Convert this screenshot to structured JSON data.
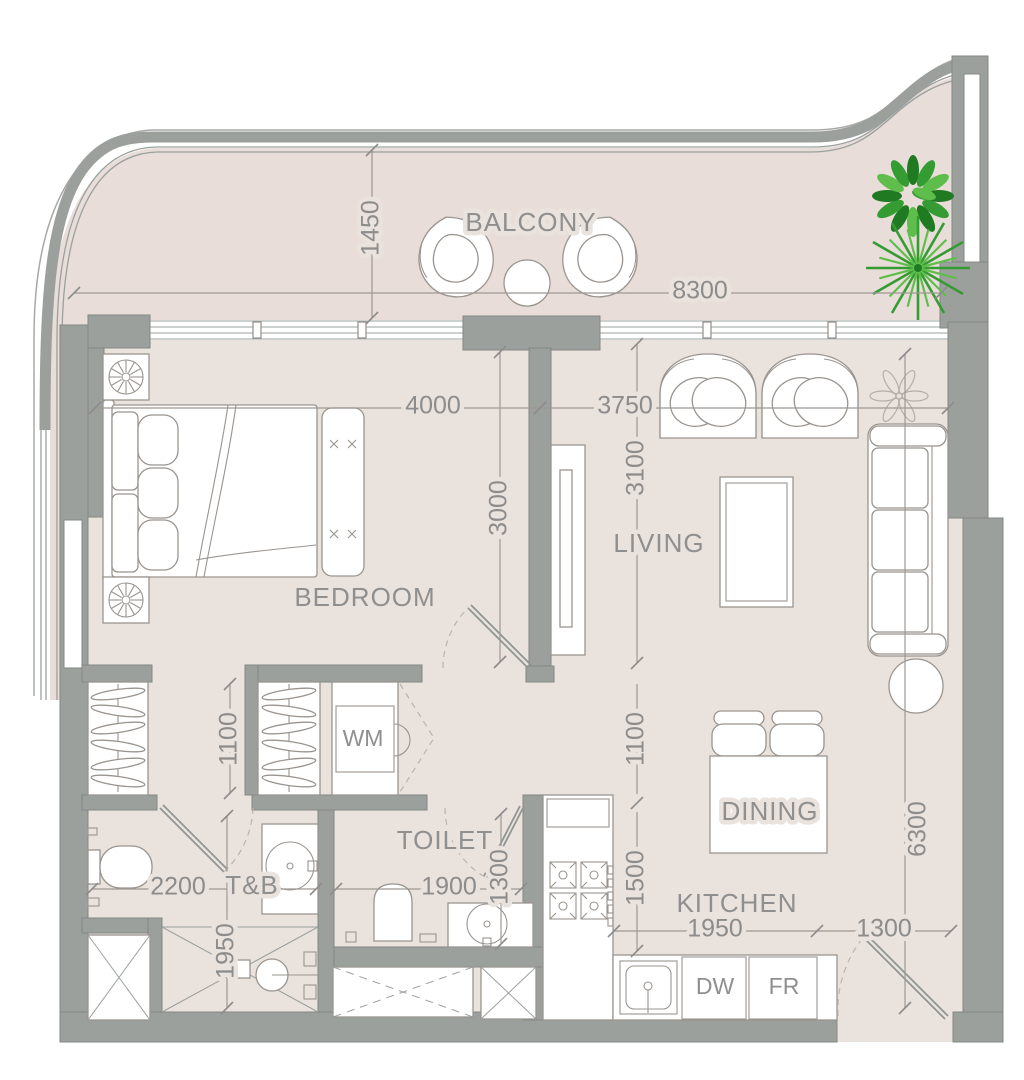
{
  "labels": {
    "balcony": "BALCONY",
    "bedroom": "BEDROOM",
    "living": "LIVING",
    "toilet": "TOILET",
    "tb": "T&B",
    "dining": "DINING",
    "kitchen": "KITCHEN",
    "wm": "WM",
    "dw": "DW",
    "fr": "FR"
  },
  "dims": {
    "balcony_depth": "1450",
    "facade_width": "8300",
    "bedroom_width": "4000",
    "living_width": "3750",
    "bedroom_depth": "3000",
    "living_depth": "3100",
    "closet_nook": "1100",
    "hall_depth": "1100",
    "kitchen_depth": "1500",
    "tb_width": "2200",
    "shower_depth": "1950",
    "toilet_width": "1900",
    "toilet_depth": "1300",
    "kitchen_width": "1950",
    "entry_width": "1300",
    "living_length": "6300"
  },
  "colors": {
    "floor": "#eae2dd",
    "balcony_floor": "#e8ddd8",
    "wall": "#9ca09d",
    "dim_text": "#8c8c8c",
    "label_text": "#8f8f8f",
    "furniture_line": "#9a948f",
    "plant_dark": "#1f7a22",
    "plant_mid": "#349c33",
    "plant_light": "#5fbe4b"
  }
}
